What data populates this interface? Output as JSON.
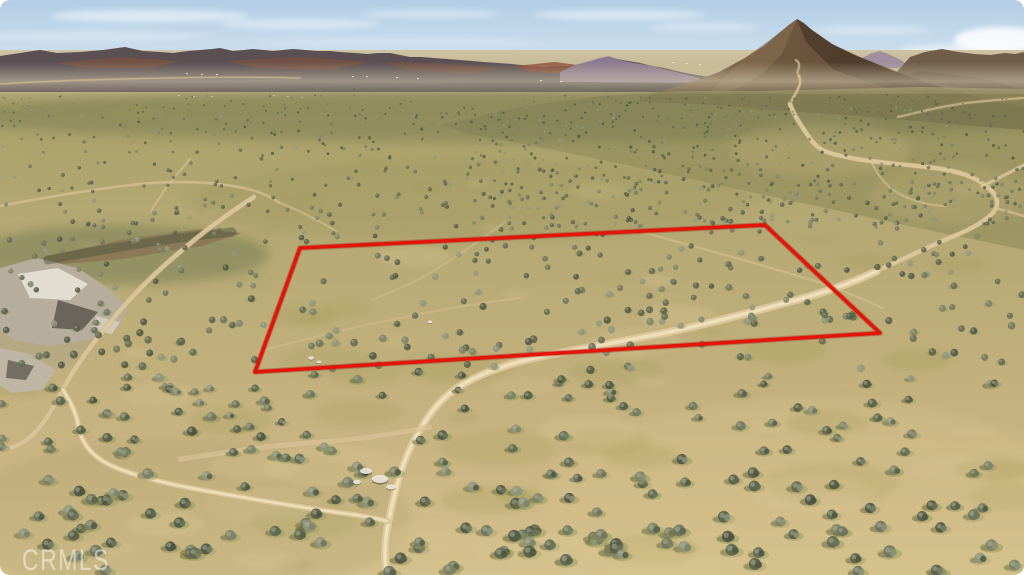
{
  "photo": {
    "alt": "Aerial drone photo of vacant desert scrub land with dirt roads, a conical hill and distant mountains; a red outline marks the parcel boundary",
    "watermark": "CRMLS"
  },
  "parcel_outline": {
    "points": "300,248 765,225 880,333 255,372",
    "color": "#e3150b",
    "underlay_color": "#8f0f06",
    "stroke_width": 3.6
  },
  "palette": {
    "sky_top": "#b2cde5",
    "sky_mid": "#cfe0ee",
    "sky_horizon": "#e7eff4",
    "haze_0": "#cfc3a5",
    "haze_1": "#b8ab7e",
    "ground_dark": "#a69e66",
    "ground_d2": "#aba26a",
    "ground_mid": "#b3a772",
    "ground_m2": "#bfae7a",
    "ground_near": "#cab583",
    "ground_front": "#d5c18d",
    "peak_light": "#7b6349",
    "peak_dark": "#56422e",
    "road": "#dcc79c",
    "road_edge": "#c3aa7b",
    "road_core": "#eedfba",
    "watermark_color": "rgba(255,255,255,0.5)"
  },
  "scene": {
    "clouds": [
      {
        "cx": 150,
        "cy": 16,
        "rx": 100,
        "ry": 6,
        "o": 0.5
      },
      {
        "cx": 300,
        "cy": 24,
        "rx": 80,
        "ry": 5,
        "o": 0.4
      },
      {
        "cx": 430,
        "cy": 14,
        "rx": 70,
        "ry": 4,
        "o": 0.38
      },
      {
        "cx": 620,
        "cy": 15,
        "rx": 85,
        "ry": 5,
        "o": 0.45
      },
      {
        "cx": 705,
        "cy": 27,
        "rx": 55,
        "ry": 4,
        "o": 0.35
      },
      {
        "cx": 90,
        "cy": 36,
        "rx": 120,
        "ry": 5,
        "o": 0.28
      },
      {
        "cx": 400,
        "cy": 42,
        "rx": 150,
        "ry": 4,
        "o": 0.22
      },
      {
        "cx": 1002,
        "cy": 40,
        "rx": 48,
        "ry": 13,
        "o": 0.85
      },
      {
        "cx": 958,
        "cy": 52,
        "rx": 60,
        "ry": 8,
        "o": 0.45
      },
      {
        "cx": 870,
        "cy": 30,
        "rx": 60,
        "ry": 5,
        "o": 0.3
      }
    ],
    "mountains": {
      "layers": [
        {
          "points": "0,92 0,56 20,53 40,50 57,53 80,52 103,50 125,47 143,51 160,52 173,53 188,51 200,50 212,49 220,48 233,51 244,50 253,49 264,50 273,51 283,50 293,49 305,50 317,51 330,51 340,52 355,53 367,54 378,53 390,53 400,55 410,57 422,57 433,58 447,59 460,60 472,61 483,62 498,63 512,64 530,66 545,67 558,66 570,66 580,64 589,62 600,58 609,57 618,59 628,61 640,63 652,66 664,68 676,71 690,74 710,77 740,80 780,83 830,86 880,88 930,88 980,87 1024,86 1024,92",
          "fill": "#5a4f52",
          "o": 1
        },
        {
          "points": "55,63 120,57 180,61 150,68 88,68",
          "fill": "#7c5343",
          "o": 0.75
        },
        {
          "points": "225,61 300,57 370,62 330,70 258,68",
          "fill": "#7c5343",
          "o": 0.7
        },
        {
          "points": "385,62 450,64 505,68 468,74 408,70",
          "fill": "#7a5040",
          "o": 0.65
        },
        {
          "points": "515,66 555,62 585,66 572,74 532,72",
          "fill": "#8a4a34",
          "o": 0.8
        },
        {
          "points": "600,62 640,64 680,72 645,78 608,70",
          "fill": "#7a4f3e",
          "o": 0.6
        },
        {
          "points": "560,72 575,65 589,61 600,58 609,56 618,59 628,62 640,64 652,66 664,69 676,72 688,75 700,78 700,83 560,82",
          "fill": "#94829b",
          "o": 0.85
        },
        {
          "points": "852,67 862,58 872,53 880,51 888,54 897,58 904,62 910,67 852,71",
          "fill": "#9b8a9e",
          "o": 0.9
        },
        {
          "points": "896,73 910,57 925,52 942,49 958,52 975,54 990,55 1005,53 1015,54 1024,52 1024,92 900,82",
          "fill": "#6f5d49",
          "o": 1
        },
        {
          "points": "890,79 920,71 950,74 985,79 1010,86 1024,91 1024,112 980,101 930,93 895,87",
          "fill": "#5f4e3d",
          "o": 0.85
        },
        {
          "points": "636,100 665,90 692,82 719,72 745,58 765,45 779,33 790,24 797,19 804,23 812,30 822,37 832,44 852,54 872,62 892,70 915,79 938,86 960,92 980,97 1000,102 1024,107 1024,130 950,124 870,117 790,111 700,104 640,102",
          "fill": "url(#peakGrad)",
          "o": 1
        },
        {
          "points": "797,19 812,30 832,44 862,58 892,70 930,84 960,92 978,97 940,97 886,88 834,70 806,42",
          "fill": "#4a3728",
          "o": 0.75
        },
        {
          "points": "745,58 779,33 797,19 782,54 762,74 740,87 722,94 704,99 726,76",
          "fill": "#8a7154",
          "o": 0.55
        },
        {
          "points": "440,125 520,107 600,96 680,91 760,91 840,89 920,87 1024,89 1024,250 900,224 760,194 640,168 540,147 468,134",
          "fill": "#96905d",
          "o": 0.75
        }
      ]
    },
    "specks": [
      [
        186,
        73
      ],
      [
        201,
        74
      ],
      [
        216,
        74
      ],
      [
        352,
        76
      ],
      [
        366,
        76
      ],
      [
        396,
        77
      ],
      [
        417,
        78
      ],
      [
        178,
        95
      ],
      [
        193,
        96
      ],
      [
        211,
        96
      ],
      [
        273,
        95
      ],
      [
        287,
        96
      ],
      [
        301,
        97
      ],
      [
        672,
        62
      ],
      [
        686,
        63
      ],
      [
        699,
        64
      ],
      [
        540,
        80
      ],
      [
        560,
        81
      ]
    ],
    "scrub_bands": [
      {
        "cx": 512,
        "cy": 116,
        "rx": 560,
        "ry": 26,
        "fill": "#6e7450",
        "o": 0.4
      },
      {
        "cx": 120,
        "cy": 255,
        "rx": 150,
        "ry": 30,
        "fill": "#5d6845",
        "o": 0.38
      },
      {
        "cx": 470,
        "cy": 200,
        "rx": 280,
        "ry": 42,
        "fill": "#99935e",
        "o": 0.3
      },
      {
        "cx": 180,
        "cy": 520,
        "rx": 230,
        "ry": 80,
        "fill": "#a89c68",
        "o": 0.25
      },
      {
        "cx": 810,
        "cy": 500,
        "rx": 270,
        "ry": 100,
        "fill": "#d7c28d",
        "o": 0.35
      },
      {
        "cx": 820,
        "cy": 150,
        "rx": 90,
        "ry": 26,
        "fill": "#c7b37f",
        "o": 0.3
      },
      {
        "cx": 950,
        "cy": 195,
        "rx": 80,
        "ry": 30,
        "fill": "#c7b37f",
        "o": 0.28
      },
      {
        "cx": 40,
        "cy": 330,
        "rx": 55,
        "ry": 38,
        "fill": "#a8a18f",
        "o": 0.45
      }
    ],
    "rocks": [
      {
        "points": "0,268 36,258 78,268 108,288 128,308 118,328 88,340 48,346 14,340 0,330",
        "fill": "#b6ad9c",
        "o": 1
      },
      {
        "points": "18,274 58,268 88,284 70,300 30,298",
        "fill": "#e7e2d6",
        "o": 0.9
      },
      {
        "points": "58,300 98,312 82,330 52,328",
        "fill": "#57514a",
        "o": 0.8
      },
      {
        "points": "0,348 30,354 56,370 42,390 12,393 0,386",
        "fill": "#beb5a4",
        "o": 1
      },
      {
        "points": "8,360 34,366 26,380 6,378",
        "fill": "#544e46",
        "o": 0.7
      },
      {
        "points": "96,316 120,322 112,334 92,330",
        "fill": "#d8d2c4",
        "o": 0.8
      },
      {
        "points": "40,258 120,240 200,229 242,233 202,246 122,259 62,264",
        "fill": "#8a7254",
        "o": 0.75
      }
    ],
    "rock_paths": [
      {
        "d": "M 48,260 C 110,248 170,238 232,232",
        "w": 9,
        "color": "#49553c",
        "o": 0.45
      }
    ],
    "roads": [
      {
        "d": "M 0,84 C 50,81 110,79 170,78 C 220,77 262,77 300,78",
        "w": 1.6,
        "o": 0.5
      },
      {
        "d": "M 0,206 C 42,198 92,189 140,184 C 180,180 221,182 252,190 C 262,193 271,197 278,202",
        "w": 2.4,
        "o": 0.6
      },
      {
        "d": "M 190,159 C 179,172 169,183 162,194 C 157,201 154,206 151,211",
        "w": 2,
        "o": 0.5
      },
      {
        "d": "M 278,202 C 298,210 318,220 336,231",
        "w": 2,
        "o": 0.45
      },
      {
        "d": "M 898,117 C 928,110 952,104 976,102 C 992,100 1010,99 1023,98",
        "w": 2,
        "o": 0.6
      },
      {
        "d": "M 872,163 C 878,176 886,186 898,193 C 912,201 928,205 944,206",
        "w": 2,
        "o": 0.5
      },
      {
        "d": "M 796,60 C 804,66 794,71 799,76",
        "w": 1.8,
        "o": 0.65
      },
      {
        "d": "M 799,76 C 803,85 795,93 791,102",
        "w": 2.2,
        "o": 0.8
      },
      {
        "d": "M 790,104 C 794,116 804,130 812,141 C 821,153 833,154 851,158 C 872,162 900,164 926,167 C 946,169 968,173 982,183 C 994,191 1000,199 996,208 C 992,217 977,226 959,234 C 934,244 906,258 877,271",
        "w": 4.2,
        "o": 0.95
      },
      {
        "d": "M 982,186 C 998,179 1012,171 1024,165",
        "w": 3,
        "o": 0.8
      },
      {
        "d": "M 995,208 C 1007,211 1017,214 1024,216",
        "w": 2.4,
        "o": 0.6
      },
      {
        "d": "M 877,271 C 846,286 812,296 789,302 C 748,313 700,326 654,335 C 608,344 573,350 544,356 C 514,362 487,371 465,383 C 447,393 435,406 426,420 C 416,436 407,452 401,472 C 394,495 389,515 386,537 C 384,552 385,564 387,575",
        "w": 8,
        "o": 1,
        "core": true
      },
      {
        "d": "M 254,197 C 230,212 203,232 180,252 C 152,275 128,300 108,325 C 88,349 72,371 61,393",
        "w": 4.4,
        "o": 0.9
      },
      {
        "d": "M 61,393 C 51,413 39,431 25,441 C 16,447 7,449 0,450",
        "w": 4.2,
        "o": 0.85
      },
      {
        "d": "M 63,390 C 70,401 76,412 78,424 C 80,441 91,456 110,465 C 133,476 167,484 207,491 C 257,500 312,509 356,515 C 369,517 379,519 387,521",
        "w": 5.5,
        "o": 0.9,
        "core": true
      },
      {
        "d": "M 430,427 C 400,433 362,439 322,442 C 292,444 263,447 236,451 C 215,454 196,457 180,459",
        "w": 5.2,
        "o": 0.6
      },
      {
        "d": "M 642,232 C 700,248 760,264 818,282 C 846,292 866,300 882,308",
        "w": 2.2,
        "o": 0.45
      },
      {
        "d": "M 505,222 C 480,240 455,258 432,272 C 412,283 392,292 372,300",
        "w": 2,
        "o": 0.35
      },
      {
        "d": "M 258,352 C 300,340 350,328 400,318 C 440,310 480,303 520,298",
        "w": 2.2,
        "o": 0.35
      }
    ],
    "debris": [
      {
        "cx": 366,
        "cy": 471,
        "rx": 6,
        "ry": 3
      },
      {
        "cx": 380,
        "cy": 479,
        "rx": 8,
        "ry": 4
      },
      {
        "cx": 391,
        "cy": 487,
        "rx": 5,
        "ry": 2.5
      },
      {
        "cx": 357,
        "cy": 482,
        "rx": 4,
        "ry": 2.2
      },
      {
        "cx": 311,
        "cy": 358,
        "rx": 3,
        "ry": 1.8
      },
      {
        "cx": 319,
        "cy": 362,
        "rx": 2.4,
        "ry": 1.4
      },
      {
        "cx": 430,
        "cy": 322,
        "rx": 2.5,
        "ry": 1.5
      }
    ],
    "mottling": {
      "seed": 77,
      "y0": 105,
      "y1": 575,
      "olive": {
        "n": 46,
        "fill": "#a09858"
      },
      "sand": {
        "n": 36,
        "fill": "#dcc795"
      }
    },
    "vegetation": {
      "seed": 1337,
      "colors": [
        "#565f49",
        "#4c5542",
        "#5f6852",
        "#6d745c",
        "#7b8268",
        "#8f967c"
      ],
      "halo": "#8f9454",
      "shadow": "#6a5f40",
      "light": "#aab2a0",
      "bands": [
        {
          "x0": 0,
          "x1": 1024,
          "y0": 94,
          "y1": 140,
          "n": 330,
          "rmin": 0.7,
          "rmax": 1.6,
          "o": 0.75
        },
        {
          "x0": 0,
          "x1": 1024,
          "y0": 140,
          "y1": 235,
          "n": 300,
          "rmin": 1.2,
          "rmax": 2.6,
          "o": 0.8
        },
        {
          "x0": 0,
          "x1": 1024,
          "y0": 235,
          "y1": 370,
          "n": 250,
          "rmin": 2.2,
          "rmax": 4.2,
          "o": 0.85
        },
        {
          "x0": 0,
          "x1": 1024,
          "y0": 370,
          "y1": 572,
          "n": 230,
          "rmin": 3.2,
          "rmax": 6.5,
          "o": 0.9,
          "fancy": true
        },
        {
          "x0": 470,
          "x1": 1024,
          "y0": 96,
          "y1": 228,
          "n": 330,
          "rmin": 0.8,
          "rmax": 2.2,
          "o": 0.8,
          "clip": {
            "x0": 470,
            "y0": 113,
            "x1": 1024,
            "y1": 68
          }
        }
      ]
    }
  }
}
